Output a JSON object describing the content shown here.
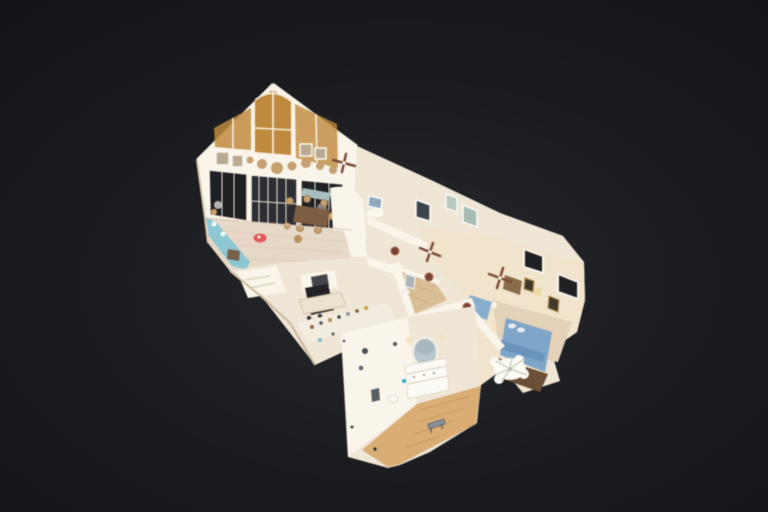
{
  "viewer": {
    "type": "3d-dollhouse-tour-view",
    "description": "cutaway dollhouse model of a single-story home floating on a dark vignetted background, viewed from an elevated oblique angle"
  },
  "colors": {
    "bg_center": "#26282c",
    "bg_mid": "#191b1f",
    "bg_edge": "#0e1014",
    "wall": "#efe6d6",
    "wall_bright": "#faf5ea",
    "wall_warm": "#f1e4cc",
    "floor": "#e7d9c8",
    "floor_bath": "#d9ad74",
    "floor_hall": "#d9bd96",
    "win_dark": "#1f2024",
    "win_glass": "#2c2e33",
    "win_amber": "#c08a3e",
    "teal": "#8cc7d2",
    "bed_blue": "#7fa5c9",
    "marker_red": "#e25a5a",
    "mirror": "#b9c6cc",
    "wood_dark": "#6b4e36",
    "tan": "#c6a071",
    "wreath": "#7d4034",
    "fan": "#7b4a3a",
    "white": "#fbfbf4"
  },
  "scene": {
    "rooms": [
      "great-room",
      "loft-landing",
      "kitchen",
      "hallway",
      "bedroom",
      "bathroom"
    ],
    "props": [
      "gable-arched-window",
      "triangle-windows",
      "wall-medallions",
      "french-doors",
      "teal-chaise",
      "red-floor-marker",
      "dining-set",
      "ceiling-fans",
      "blue-bed",
      "round-mirror",
      "vanity",
      "bench",
      "chandelier"
    ]
  }
}
